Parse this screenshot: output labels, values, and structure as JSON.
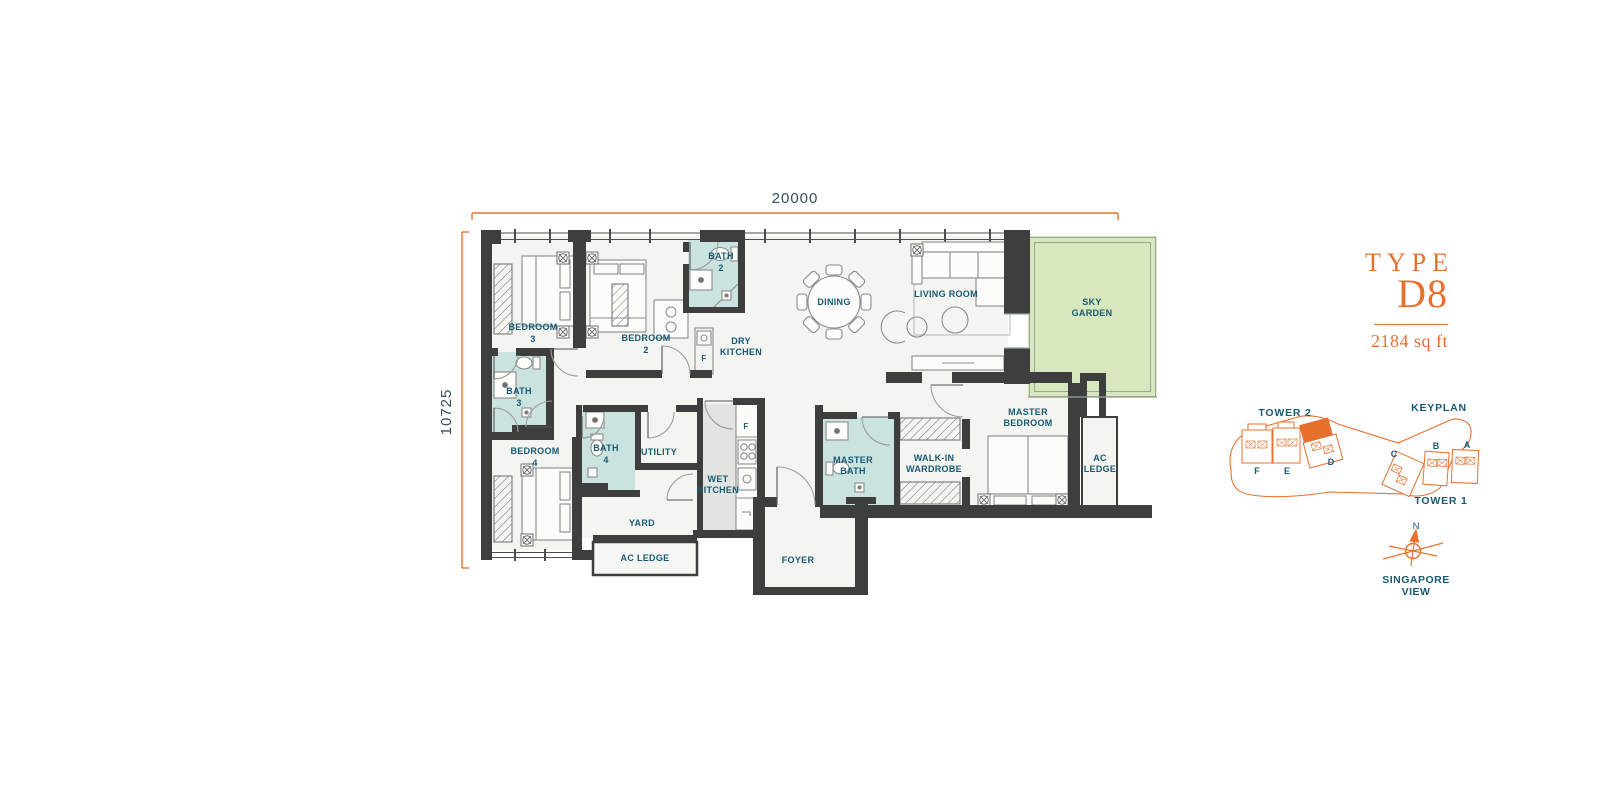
{
  "title_block": {
    "type_label": "TYPE",
    "type_code": "D8",
    "area": "2184 sq ft"
  },
  "dimensions": {
    "width_label": "20000",
    "height_label": "10725"
  },
  "colors": {
    "accent_orange": "#E8702D",
    "label_navy": "#175A74",
    "wall": "#3E3E3E",
    "bath_fill": "#CAE3DF",
    "garden_fill": "#D7E7BE",
    "wet_kitchen_fill": "#E3E3E0",
    "floor_fill": "#F4F4F1"
  },
  "rooms": {
    "bedroom3": {
      "l1": "BEDROOM",
      "l2": "3"
    },
    "bedroom2": {
      "l1": "BEDROOM",
      "l2": "2"
    },
    "bedroom4": {
      "l1": "BEDROOM",
      "l2": "4"
    },
    "bath2": {
      "l1": "BATH",
      "l2": "2"
    },
    "bath3": {
      "l1": "BATH",
      "l2": "3"
    },
    "bath4": {
      "l1": "BATH",
      "l2": "4"
    },
    "dining": {
      "l1": "DINING"
    },
    "living_room": {
      "l1": "LIVING ROOM"
    },
    "sky_garden": {
      "l1": "SKY",
      "l2": "GARDEN"
    },
    "dry_kitchen": {
      "l1": "DRY",
      "l2": "KITCHEN"
    },
    "wet_kitchen": {
      "l1": "WET",
      "l2": "KITCHEN"
    },
    "utility": {
      "l1": "UTILITY"
    },
    "yard": {
      "l1": "YARD"
    },
    "ac_ledge_bottom": {
      "l1": "AC LEDGE"
    },
    "ac_ledge_right": {
      "l1": "AC",
      "l2": "LEDGE"
    },
    "master_bedroom": {
      "l1": "MASTER",
      "l2": "BEDROOM"
    },
    "master_bath": {
      "l1": "MASTER",
      "l2": "BATH"
    },
    "walk_in_wardrobe": {
      "l1": "WALK-IN",
      "l2": "WARDROBE"
    },
    "foyer": {
      "l1": "FOYER"
    },
    "fridge_dry": "F",
    "fridge_wet": "F"
  },
  "keyplan": {
    "title": "KEYPLAN",
    "tower2": "TOWER 2",
    "tower1": "TOWER 1",
    "units": {
      "f": "F",
      "e": "E",
      "d": "D",
      "c": "C",
      "b": "B",
      "a": "A"
    },
    "compass_icon": "north-compass",
    "compass_n": "N",
    "view_l1": "SINGAPORE",
    "view_l2": "VIEW"
  }
}
